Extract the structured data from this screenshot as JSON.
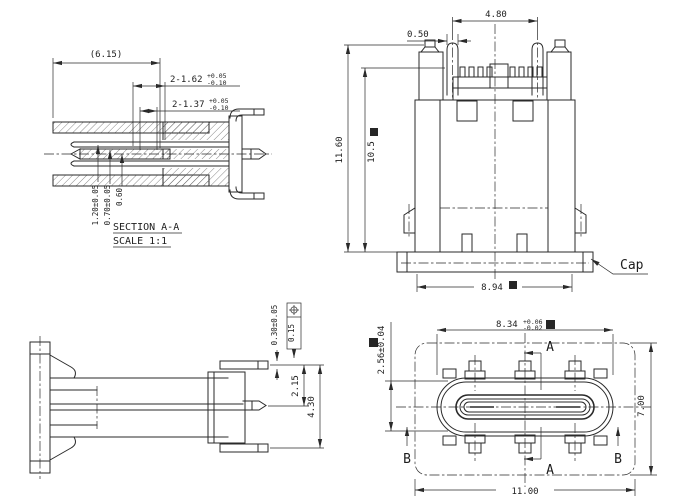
{
  "meta": {
    "background": "#ffffff",
    "line_color": "#2a2a2a",
    "drawing_type": "connector mechanical drawing (USB Type-C receptacle)"
  },
  "icons": {
    "critical_dim_marker": "■",
    "position_tolerance_symbol": "⌖"
  },
  "views": {
    "section": {
      "name_label": "SECTION A-A",
      "scale_label": "SCALE 1:1",
      "dim_overall": "(6.15)",
      "dim_slot_a": "2-1.62",
      "dim_slot_a_tol_plus": "+0.05",
      "dim_slot_a_tol_minus": "-0.10",
      "dim_slot_b": "2-1.37",
      "dim_slot_b_tol_plus": "+0.05",
      "dim_slot_b_tol_minus": "-0.10",
      "dim_v1": "1.20±0.05",
      "dim_v2": "0.70±0.05",
      "dim_v3": "0.60"
    },
    "front": {
      "dim_pin_pitch": "4.80",
      "dim_pin_width": "0.50",
      "dim_height_total": "11.60",
      "dim_height_body": "10.5",
      "dim_cap_width": "8.94",
      "cap_label": "Cap"
    },
    "side": {
      "dim_pin": "0.30±0.05",
      "gdt_value": "0.15",
      "dim_pitch_1": "2.15",
      "dim_pitch_2": "4.30"
    },
    "top": {
      "dim_shell_w": "8.34",
      "dim_shell_w_tol_plus": "+0.06",
      "dim_shell_w_tol_minus": "-0.02",
      "dim_shell_h": "2.56±0.04",
      "dim_body_h": "7.00",
      "dim_body_w": "11.00",
      "section_a_top": "A",
      "section_a_bottom": "A",
      "section_b_left": "B",
      "section_b_right": "B"
    }
  }
}
